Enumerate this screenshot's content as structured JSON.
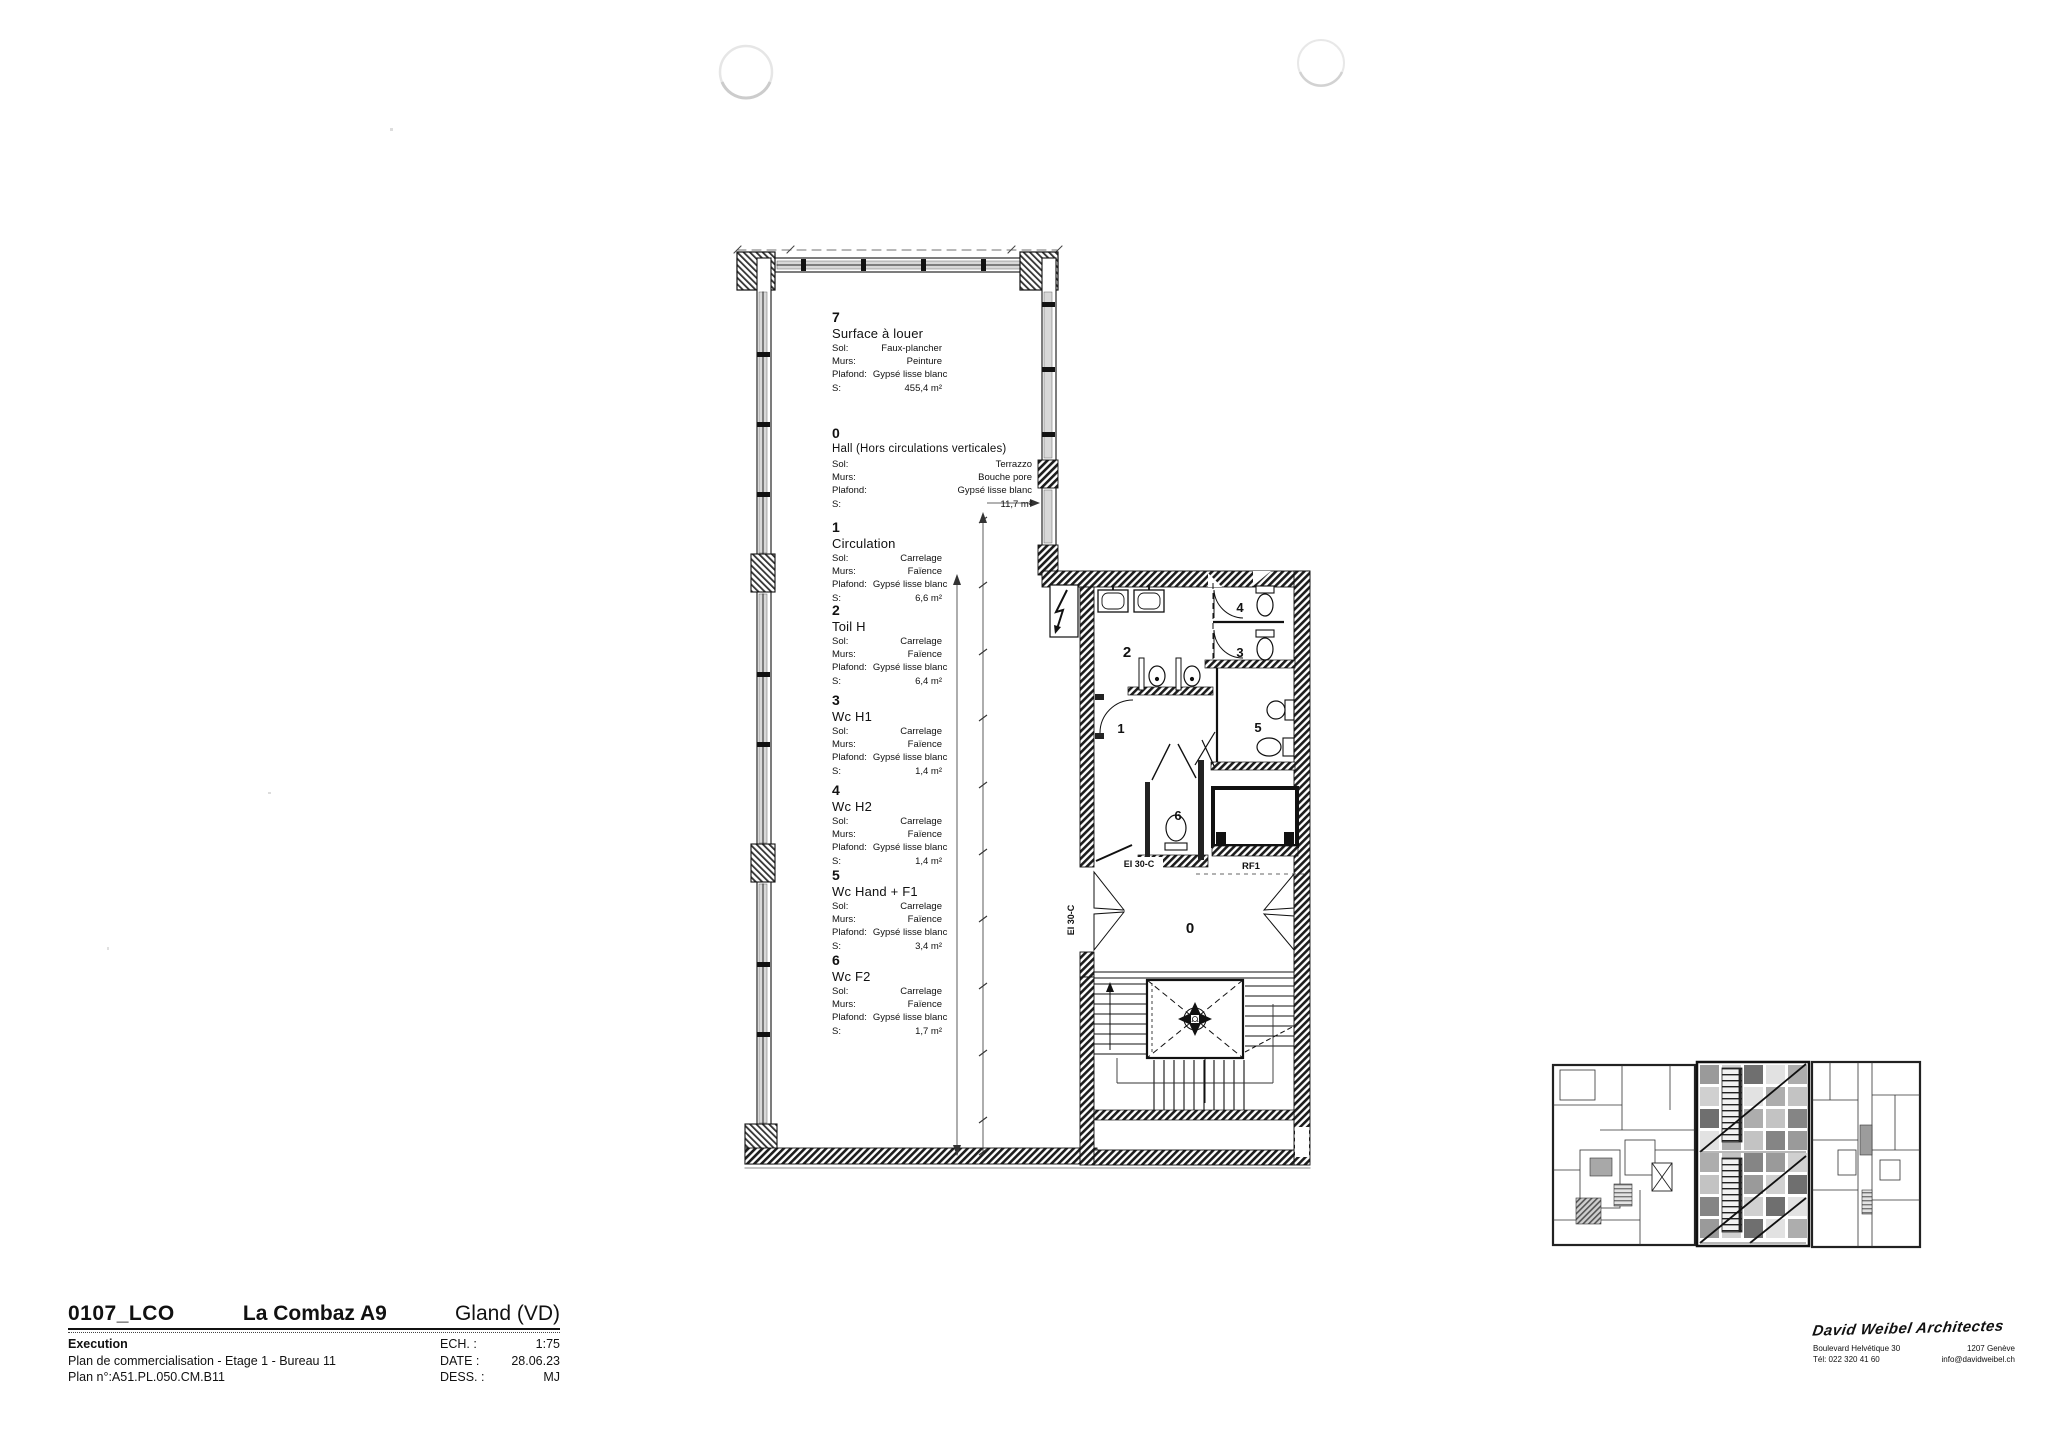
{
  "legend": {
    "labels": {
      "sol": "Sol:",
      "murs": "Murs:",
      "plafond": "Plafond:",
      "surface": "S:"
    },
    "rooms": [
      {
        "num": "7",
        "name": "Surface à louer",
        "sol": "Faux-plancher",
        "murs": "Peinture",
        "plafond": "Gypsé lisse blanc",
        "surface": "455,4 m²"
      },
      {
        "num": "0",
        "name": "Hall (Hors circulations verticales)",
        "sol": "Terrazzo",
        "murs": "Bouche pore",
        "plafond": "Gypsé lisse blanc",
        "surface": "11,7 m²"
      },
      {
        "num": "1",
        "name": "Circulation",
        "sol": "Carrelage",
        "murs": "Faïence",
        "plafond": "Gypsé lisse blanc",
        "surface": "6,6 m²"
      },
      {
        "num": "2",
        "name": "Toil H",
        "sol": "Carrelage",
        "murs": "Faïence",
        "plafond": "Gypsé lisse blanc",
        "surface": "6,4 m²"
      },
      {
        "num": "3",
        "name": "Wc H1",
        "sol": "Carrelage",
        "murs": "Faïence",
        "plafond": "Gypsé lisse blanc",
        "surface": "1,4 m²"
      },
      {
        "num": "4",
        "name": "Wc H2",
        "sol": "Carrelage",
        "murs": "Faïence",
        "plafond": "Gypsé lisse blanc",
        "surface": "1,4 m²"
      },
      {
        "num": "5",
        "name": "Wc Hand + F1",
        "sol": "Carrelage",
        "murs": "Faïence",
        "plafond": "Gypsé lisse blanc",
        "surface": "3,4 m²"
      },
      {
        "num": "6",
        "name": "Wc F2",
        "sol": "Carrelage",
        "murs": "Faïence",
        "plafond": "Gypsé lisse blanc",
        "surface": "1,7 m²"
      }
    ]
  },
  "plan": {
    "numbers": {
      "hall": "0",
      "circulation": "1",
      "toil_h": "2",
      "wc_h1": "3",
      "wc_h2": "4",
      "wc_hand_f1": "5",
      "wc_f2": "6"
    },
    "fire_door_label": "EI 30-C",
    "shaft_label": "RF1"
  },
  "title_block": {
    "project_code": "0107_LCO",
    "project_name": "La Combaz A9",
    "location": "Gland (VD)",
    "phase": "Execution",
    "plan_title": "Plan de commercialisation - Etage 1 - Bureau 11",
    "plan_number": "Plan n°:A51.PL.050.CM.B11",
    "ech_label": "ECH. :",
    "ech_value": "1:75",
    "date_label": "DATE :",
    "date_value": "28.06.23",
    "dess_label": "DESS. :",
    "dess_value": "MJ"
  },
  "architect": {
    "signature": "David Weibel Architectes",
    "address": "Boulevard Helvétique 30",
    "city": "1207 Genève",
    "phone": "Tél: 022 320 41 60",
    "email": "info@davidweibel.ch"
  },
  "colors": {
    "ink": "#111111",
    "glazing": "#d8d8d8",
    "scan_artifact": "#dedede"
  }
}
